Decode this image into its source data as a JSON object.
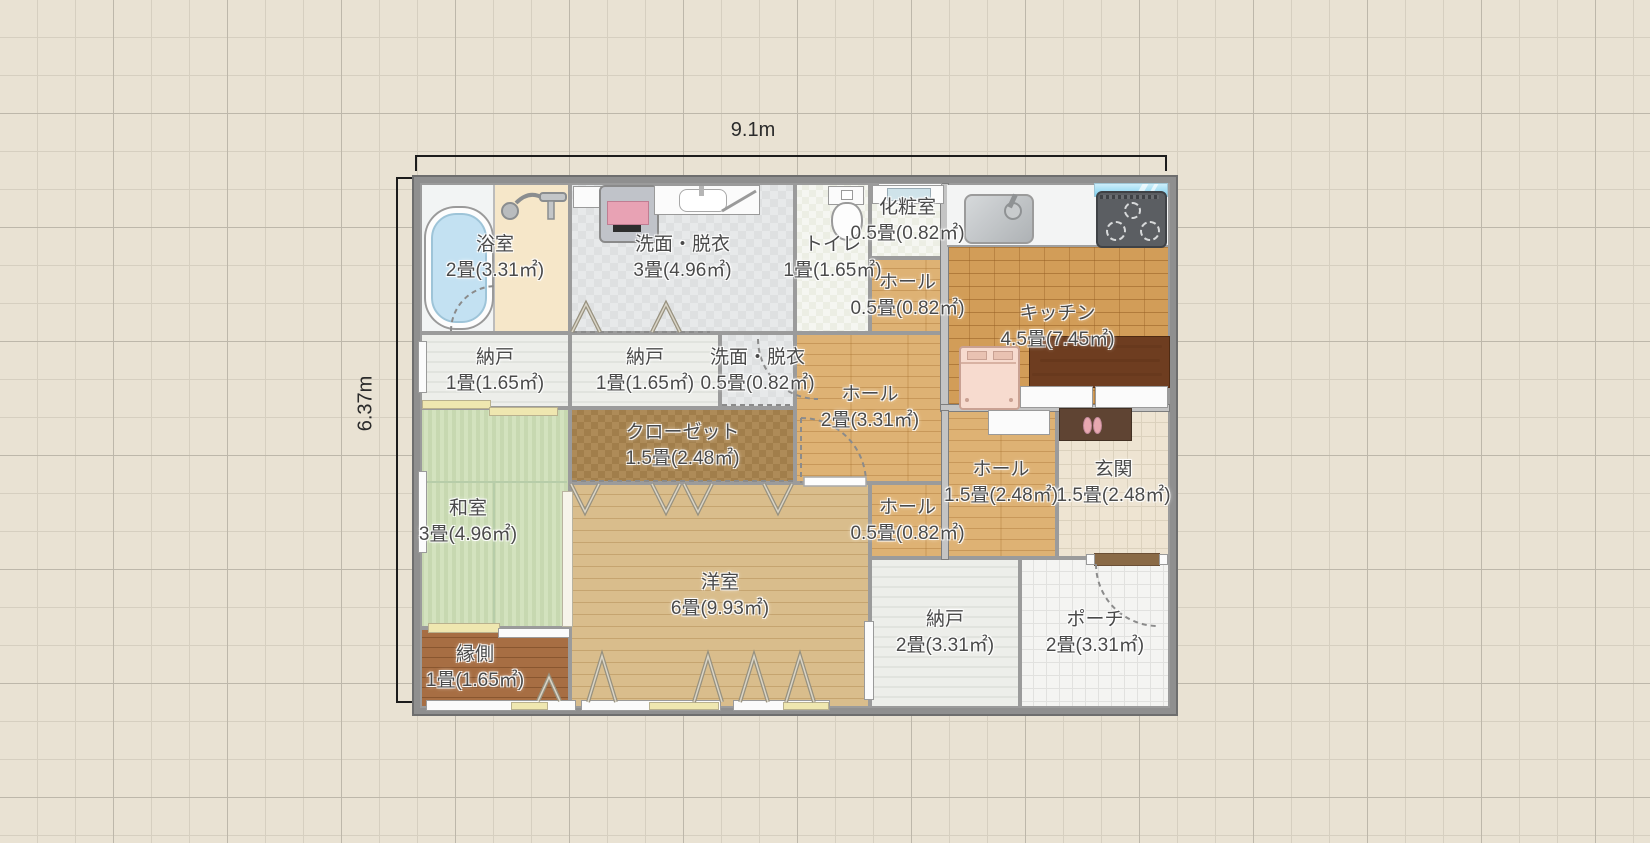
{
  "dims": {
    "width_label": "9.1m",
    "height_label": "6.37m"
  },
  "rooms": [
    {
      "id": "bathroom",
      "name": "浴室",
      "size": "2畳(3.31㎡)"
    },
    {
      "id": "washroom",
      "name": "洗面・脱衣",
      "size": "3畳(4.96㎡)"
    },
    {
      "id": "toilet",
      "name": "トイレ",
      "size": "1畳(1.65㎡)"
    },
    {
      "id": "powder-room",
      "name": "化粧室",
      "size": "0.5畳(0.82㎡)"
    },
    {
      "id": "hall-north",
      "name": "ホール",
      "size": "0.5畳(0.82㎡)"
    },
    {
      "id": "kitchen",
      "name": "キッチン",
      "size": "4.5畳(7.45㎡)"
    },
    {
      "id": "storage-1",
      "name": "納戸",
      "size": "1畳(1.65㎡)"
    },
    {
      "id": "storage-2",
      "name": "納戸",
      "size": "1畳(1.65㎡)"
    },
    {
      "id": "washroom-small",
      "name": "洗面・脱衣",
      "size": "0.5畳(0.82㎡)"
    },
    {
      "id": "hall-center",
      "name": "ホール",
      "size": "2畳(3.31㎡)"
    },
    {
      "id": "closet",
      "name": "クローゼット",
      "size": "1.5畳(2.48㎡)"
    },
    {
      "id": "japanese-room",
      "name": "和室",
      "size": "3畳(4.96㎡)"
    },
    {
      "id": "hall-entrance",
      "name": "ホール",
      "size": "1.5畳(2.48㎡)"
    },
    {
      "id": "entrance",
      "name": "玄関",
      "size": "1.5畳(2.48㎡)"
    },
    {
      "id": "hall-small",
      "name": "ホール",
      "size": "0.5畳(0.82㎡)"
    },
    {
      "id": "western-room",
      "name": "洋室",
      "size": "6畳(9.93㎡)"
    },
    {
      "id": "veranda",
      "name": "縁側",
      "size": "1畳(1.65㎡)"
    },
    {
      "id": "storage-3",
      "name": "納戸",
      "size": "2畳(3.31㎡)"
    },
    {
      "id": "porch",
      "name": "ポーチ",
      "size": "2畳(3.31㎡)"
    }
  ],
  "fixtures": [
    "bathtub",
    "shower",
    "washing-machine",
    "vanity-sink",
    "mirror",
    "toilet",
    "powder-sink",
    "kitchen-sink",
    "gas-stove",
    "window-glass",
    "refrigerator",
    "dining-table",
    "kitchen-cabinet",
    "hall-cabinet",
    "shoe-cabinet",
    "slippers",
    "front-door",
    "sliding-door",
    "folding-door",
    "door-swing-arc"
  ]
}
